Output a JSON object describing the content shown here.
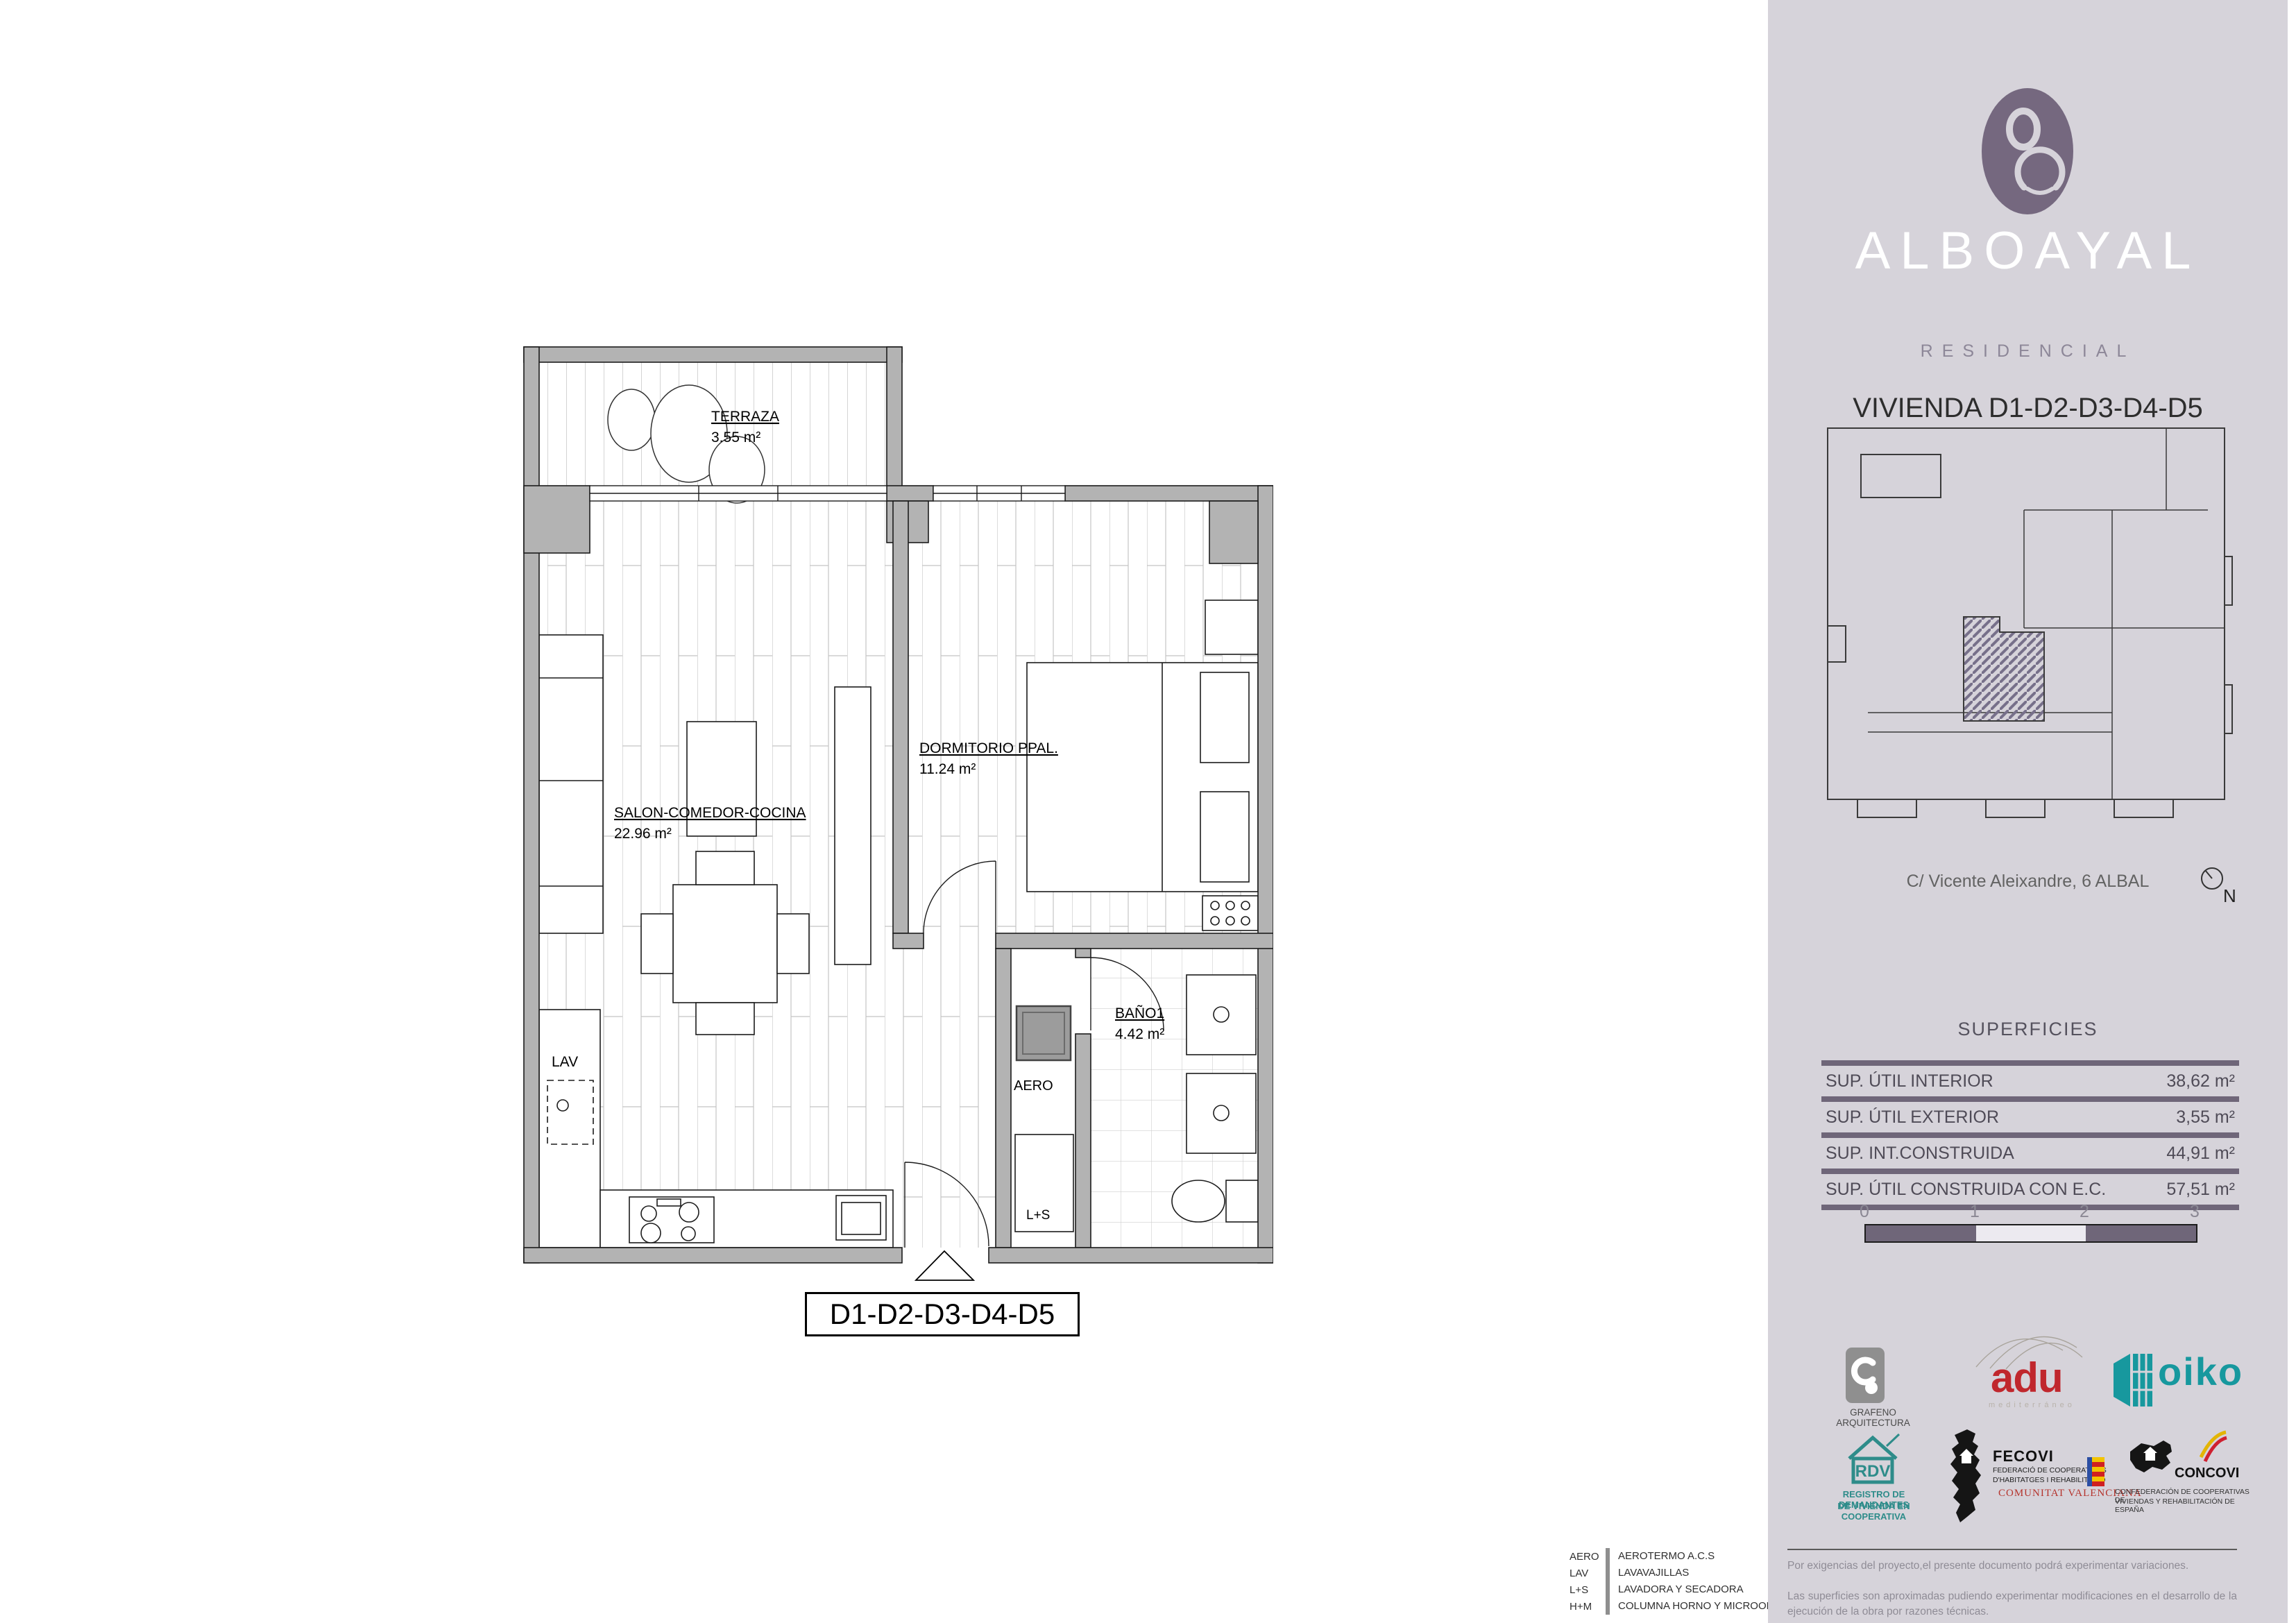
{
  "plan": {
    "title": "D1-D2-D3-D4-D5",
    "rooms": {
      "terraza": {
        "name": "TERRAZA",
        "area": "3.55 m²"
      },
      "salon": {
        "name": "SALON-COMEDOR-COCINA",
        "area": "22.96 m²"
      },
      "dormitorio": {
        "name": "DORMITORIO PPAL.",
        "area": "11.24 m²"
      },
      "bano": {
        "name": "BAÑO1",
        "area": "4.42 m²"
      }
    },
    "labels": {
      "lav": "LAV",
      "aero": "AERO",
      "ls": "L+S"
    }
  },
  "legend": {
    "rows": [
      {
        "abbr": "AERO",
        "desc": "AEROTERMO A.C.S"
      },
      {
        "abbr": "LAV",
        "desc": "LAVAVAJILLAS"
      },
      {
        "abbr": "L+S",
        "desc": "LAVADORA Y SECADORA"
      },
      {
        "abbr": "H+M",
        "desc": "COLUMNA HORNO Y MICROONDAS"
      }
    ]
  },
  "sidebar": {
    "brand": {
      "name": "ALBOAYAL",
      "tagline": "RESIDENCIAL"
    },
    "unit_title": "VIVIENDA  D1-D2-D3-D4-D5",
    "address": "C/ Vicente Aleixandre, 6 ALBAL",
    "north": "N",
    "superficies": {
      "title": "SUPERFICIES",
      "rows": [
        {
          "label": "SUP. ÚTIL INTERIOR",
          "value": "38,62 m²"
        },
        {
          "label": "SUP. ÚTIL EXTERIOR",
          "value": "3,55 m²"
        },
        {
          "label": "SUP. INT.CONSTRUIDA",
          "value": "44,91 m²"
        },
        {
          "label": "SUP. ÚTIL CONSTRUIDA CON E.C.",
          "value": "57,51 m²"
        }
      ]
    },
    "scale": {
      "t0": "0",
      "t1": "1",
      "t2": "2",
      "t3": "3"
    },
    "logos": {
      "grafeno": {
        "caption": "GRAFENO ARQUITECTURA"
      },
      "adu": {
        "name": "adu",
        "sub": "mediterráneo"
      },
      "oiko": {
        "name": "oiko"
      },
      "rdv": {
        "abbr": "RDV",
        "caption1": "REGISTRO DE DEMANDANTES",
        "caption2": "DE VIVIENDA EN COOPERATIVA"
      },
      "fecovi": {
        "name": "FECOVI",
        "line1": "FEDERACIÓ DE COOPERATIVES",
        "line2": "D'HABITATGES I REHABILITACIÓ",
        "line3": "COMUNITAT VALENCIANA"
      },
      "concovi": {
        "name": "CONCOVI",
        "caption1": "CONFEDERACIÓN DE COOPERATIVAS DE",
        "caption2": "VIVIENDAS Y REHABILITACIÓN DE ESPAÑA"
      }
    },
    "disclaimer1": "Por exigencias del proyecto,el presente documento podrá experimentar variaciones.",
    "disclaimer2": "Las superficies son aproximadas pudiendo experimentar modificaciones en el desarrollo de la ejecución de la obra por razones técnicas."
  },
  "colors": {
    "accent": "#6f6679",
    "sidebar_bg": "#d6d3da",
    "wall_gray": "#b3b3b3",
    "adu_red": "#c0272d",
    "oiko_teal": "#17989e",
    "rdv_teal": "#2e8c8a",
    "fecovi_red": "#b5342d"
  }
}
